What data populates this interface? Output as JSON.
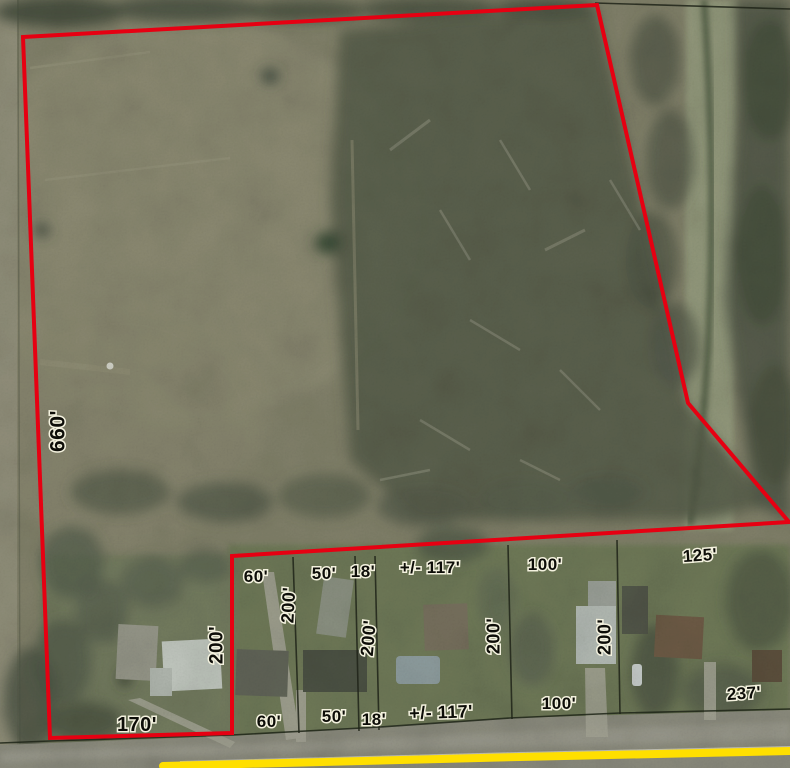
{
  "map": {
    "type": "aerial-parcel-survey",
    "description": "Aerial photo with red-outlined land parcel, neighboring lot lines and dimension annotations, road with yellow centerline at bottom",
    "colors": {
      "parcel_boundary": "#e60012",
      "lot_line": "#1f2418",
      "road_stripe_yellow": "#ffdf00",
      "label_fill": "#0d0d08",
      "label_outline": "#f3f1de"
    },
    "parcel_boundary_points": "23,37 597,5 688,403 789,522 232,556 232,733 50,738",
    "road_stripe_points": "163,766 520,757 790,751",
    "road_edge_points": "0,743 50,741 232,735 380,727 510,718 620,713 790,709",
    "lot_lines": [
      [
        595,
        3,
        790,
        9
      ],
      [
        293,
        557,
        299,
        733
      ],
      [
        355,
        556,
        359,
        731
      ],
      [
        375,
        556,
        379,
        730
      ],
      [
        508,
        545,
        512,
        719
      ],
      [
        617,
        540,
        620,
        714
      ]
    ],
    "dimension_labels": [
      {
        "t": "660'",
        "x": 57,
        "y": 431,
        "r": -90,
        "s": 21
      },
      {
        "t": "170'",
        "x": 137,
        "y": 724,
        "r": 0,
        "s": 20
      },
      {
        "t": "200'",
        "x": 216,
        "y": 645,
        "r": -90,
        "s": 19
      },
      {
        "t": "60'",
        "x": 256,
        "y": 576,
        "r": 0,
        "s": 17
      },
      {
        "t": "200'",
        "x": 288,
        "y": 605,
        "r": -87,
        "s": 18
      },
      {
        "t": "50'",
        "x": 324,
        "y": 573,
        "r": 0,
        "s": 17
      },
      {
        "t": "18'",
        "x": 363,
        "y": 571,
        "r": 0,
        "s": 17
      },
      {
        "t": "+/- 117'",
        "x": 430,
        "y": 567,
        "r": 0,
        "s": 17
      },
      {
        "t": "100'",
        "x": 545,
        "y": 564,
        "r": 0,
        "s": 17
      },
      {
        "t": "125'",
        "x": 700,
        "y": 555,
        "r": -4,
        "s": 17
      },
      {
        "t": "200'",
        "x": 368,
        "y": 638,
        "r": -85,
        "s": 18
      },
      {
        "t": "200'",
        "x": 493,
        "y": 636,
        "r": -90,
        "s": 18
      },
      {
        "t": "200'",
        "x": 604,
        "y": 637,
        "r": -90,
        "s": 18
      },
      {
        "t": "60'",
        "x": 269,
        "y": 721,
        "r": 0,
        "s": 17
      },
      {
        "t": "50'",
        "x": 334,
        "y": 716,
        "r": 0,
        "s": 17
      },
      {
        "t": "18'",
        "x": 374,
        "y": 719,
        "r": 0,
        "s": 17
      },
      {
        "t": "+/- 117'",
        "x": 441,
        "y": 712,
        "r": -2,
        "s": 18
      },
      {
        "t": "100'",
        "x": 559,
        "y": 703,
        "r": 0,
        "s": 17
      },
      {
        "t": "237'",
        "x": 744,
        "y": 693,
        "r": -4,
        "s": 17
      }
    ]
  }
}
